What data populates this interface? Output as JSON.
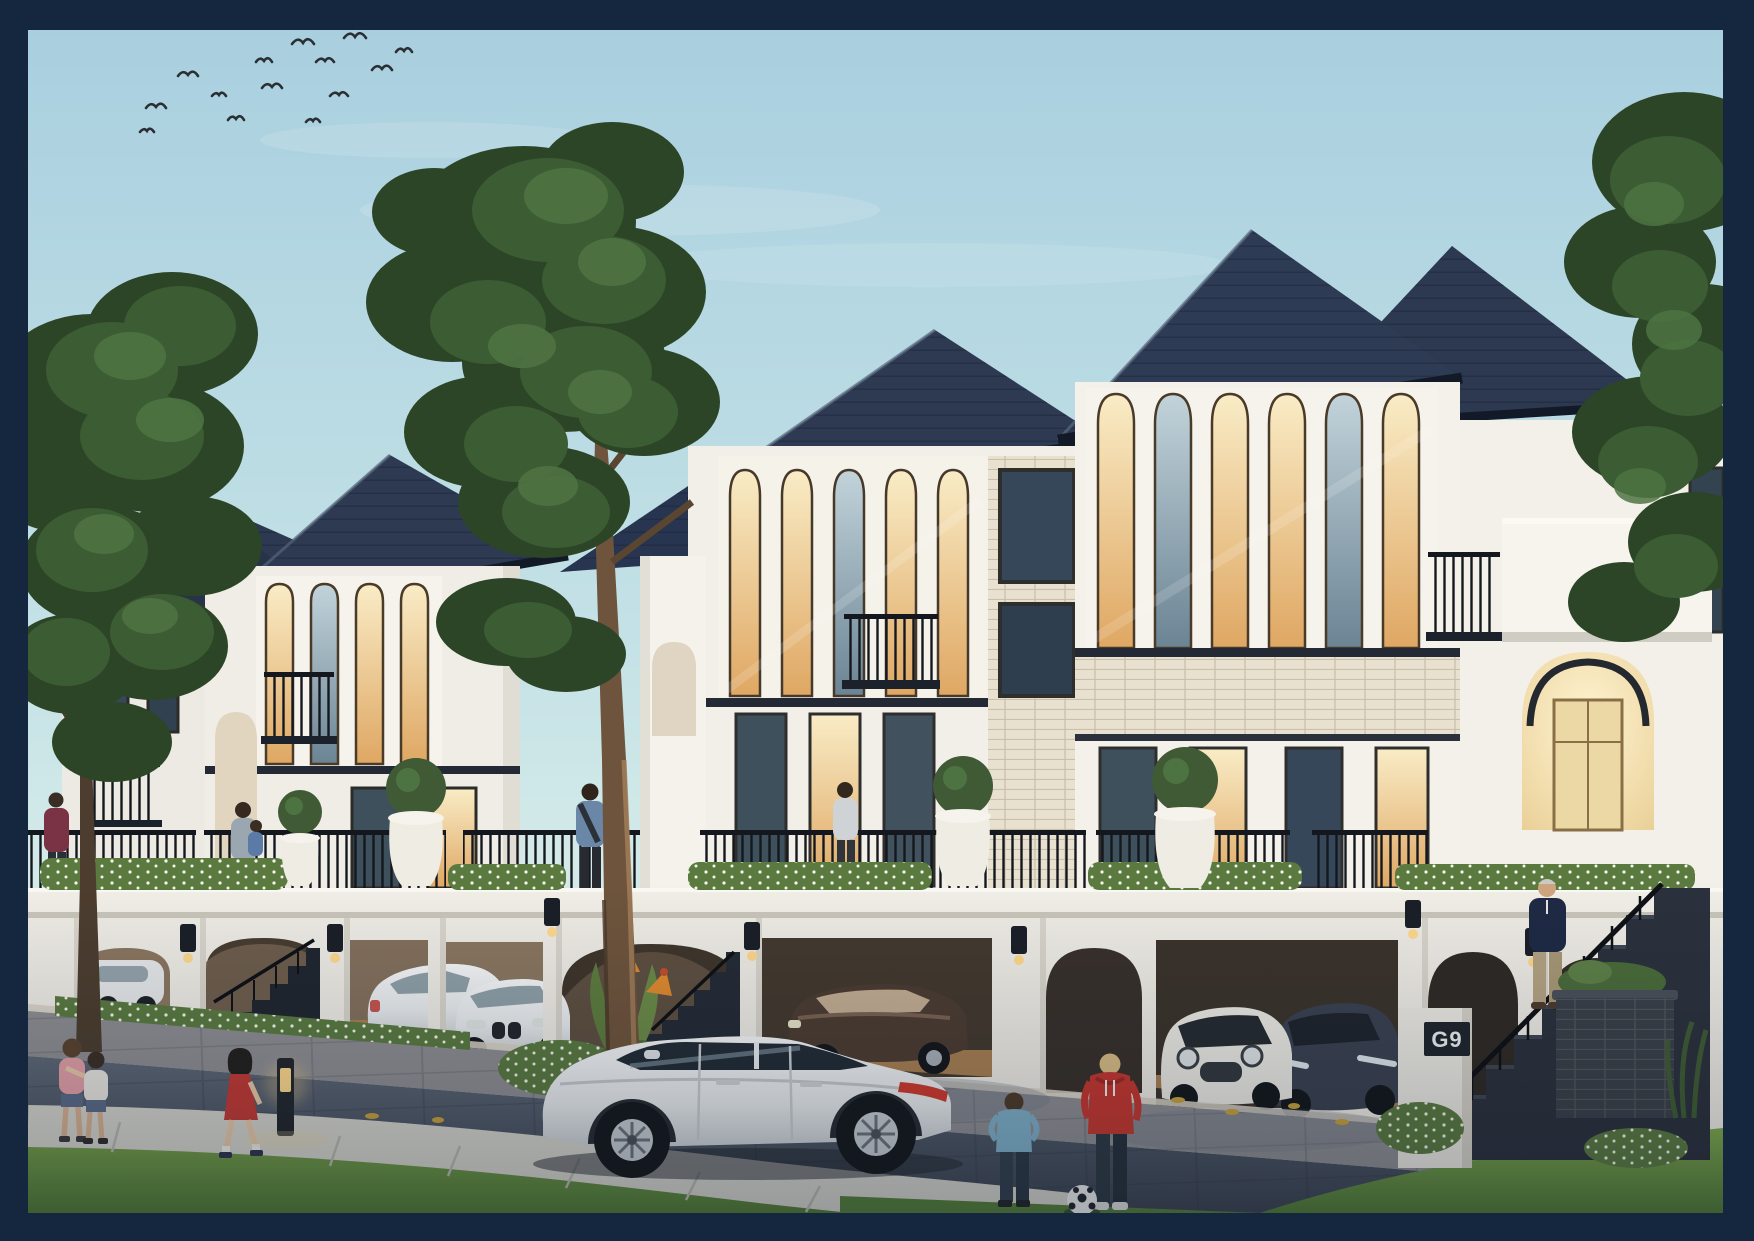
{
  "frame": {
    "border_color": "#14273f",
    "border_width_px": 28
  },
  "scene": {
    "setting": "dusk architectural rendering of a modern-classic townhouse row",
    "sky": {
      "top_color": "#a9cfdf",
      "horizon_color": "#e8f3ec",
      "birds_count": 14
    },
    "architecture": {
      "roof_color": "#2d3a52",
      "roof_tile_line_color": "#0f1626",
      "fascia_color": "#121a28",
      "wall_color": "#f2efe8",
      "wall_shadow_color": "#e0ddd5",
      "brick_color": "#e9e1cf",
      "window_frame_color": "#4a3a28",
      "window_glow_color": "#f0d9a4",
      "window_cool_color": "#7d95a3",
      "railing_color": "#15181d",
      "terrace_beam_color": "#f2efe8",
      "carport_floor_color": "#a87f52",
      "units": [
        "far-left unit",
        "left unit",
        "center unit",
        "right tower unit",
        "right entry wing"
      ]
    },
    "house_number_sign": {
      "text": "G9",
      "background": "#20252c",
      "color": "#eef0f0"
    },
    "vehicles": [
      {
        "id": "white-sedan-far-left",
        "color": "#e6e8e9"
      },
      {
        "id": "white-audi-sedan",
        "color": "#e9eaea"
      },
      {
        "id": "white-bmw-sedan",
        "color": "#eff0f1"
      },
      {
        "id": "brown-porsche-panamera",
        "color": "#4c3c31"
      },
      {
        "id": "white-mini-cooper",
        "color": "#eceae4"
      },
      {
        "id": "dark-gray-sedan",
        "color": "#3a4150"
      },
      {
        "id": "white-porsche-panamera-foreground",
        "color": "#eef0f1"
      }
    ],
    "people": [
      {
        "id": "woman-maroon-balcony-far-left"
      },
      {
        "id": "mother-with-child-terrace"
      },
      {
        "id": "man-blue-shirt-terrace"
      },
      {
        "id": "woman-terrace-center"
      },
      {
        "id": "man-gray-hair-on-stairs"
      },
      {
        "id": "girls-hugging-on-path"
      },
      {
        "id": "girl-red-dress-walking"
      },
      {
        "id": "boy-blue-shirt-football"
      },
      {
        "id": "boy-red-hoodie-football"
      }
    ],
    "props": [
      {
        "id": "soccer-ball",
        "color": "#eef0ef"
      },
      {
        "id": "bollard-path-light",
        "glow_color": "#ffd98c"
      },
      {
        "id": "white-garden-urns",
        "color": "#efece4"
      },
      {
        "id": "dark-brick-planter",
        "color": "#3a4049"
      }
    ],
    "vegetation": {
      "tree_foliage_dark": "#2c4527",
      "tree_foliage_mid": "#3c5c34",
      "tree_foliage_light": "#4e7342",
      "grass_color": "#6c9a45",
      "hedge_color": "#5a7a40",
      "flower_accent_color": "#e08a2e"
    },
    "street": {
      "apron_color": "#8e8e92",
      "pavement_color": "#49525f",
      "curb_color": "#d8d2c4",
      "path_color": "#d6d5cd",
      "fallen_leaves_color": "#c9a13b"
    }
  }
}
